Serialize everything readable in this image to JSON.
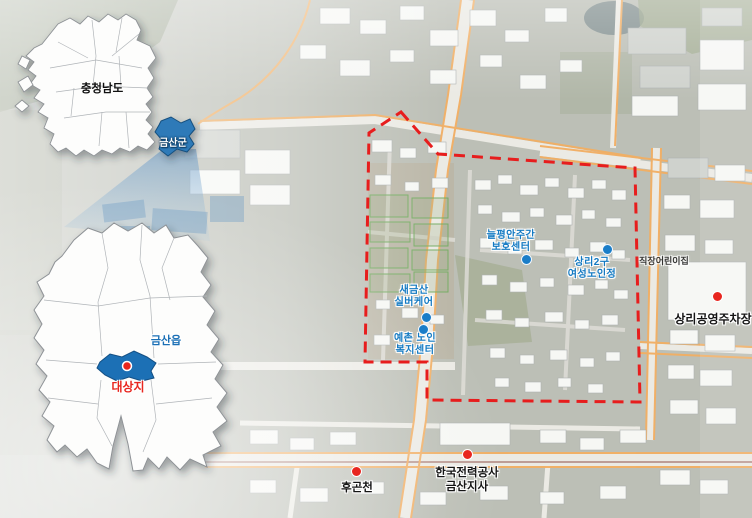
{
  "locator": {
    "province": {
      "name": "충청남도",
      "highlight": "금산군"
    },
    "county": {
      "highlight": "금산읍",
      "site": "대상지"
    }
  },
  "site_pois": [
    {
      "id": "neulpyeongan-daycare-center",
      "lines": [
        "늘평안주간",
        "보호센터"
      ]
    },
    {
      "id": "sangri-2gu-womens-senior-hall",
      "lines": [
        "상리2구",
        "여성노인정"
      ]
    },
    {
      "id": "sae-geumsan-silver-care",
      "lines": [
        "새금산",
        "실버케어"
      ]
    },
    {
      "id": "yechon-senior-welfare-center",
      "lines": [
        "예촌 노인",
        "복지센터"
      ]
    }
  ],
  "landmarks": [
    {
      "id": "sangri-public-parking",
      "lines": [
        "상리공영주차장"
      ]
    },
    {
      "id": "hugoncheon",
      "lines": [
        "후곤천"
      ]
    },
    {
      "id": "kepco-geumsan-branch",
      "lines": [
        "한국전력공사",
        "금산지사"
      ]
    }
  ],
  "basemap_labels": [
    {
      "id": "workplace-daycare",
      "text": "직장어린이집"
    }
  ],
  "colors": {
    "boundary_red": "#e71d1d",
    "poi_blue": "#1279c2",
    "marker_red": "#e8261f",
    "county_highlight_blue": "#1a6fb5",
    "province_highlight_blue": "#2e7ab8",
    "road_orange": "#f1a34d"
  }
}
